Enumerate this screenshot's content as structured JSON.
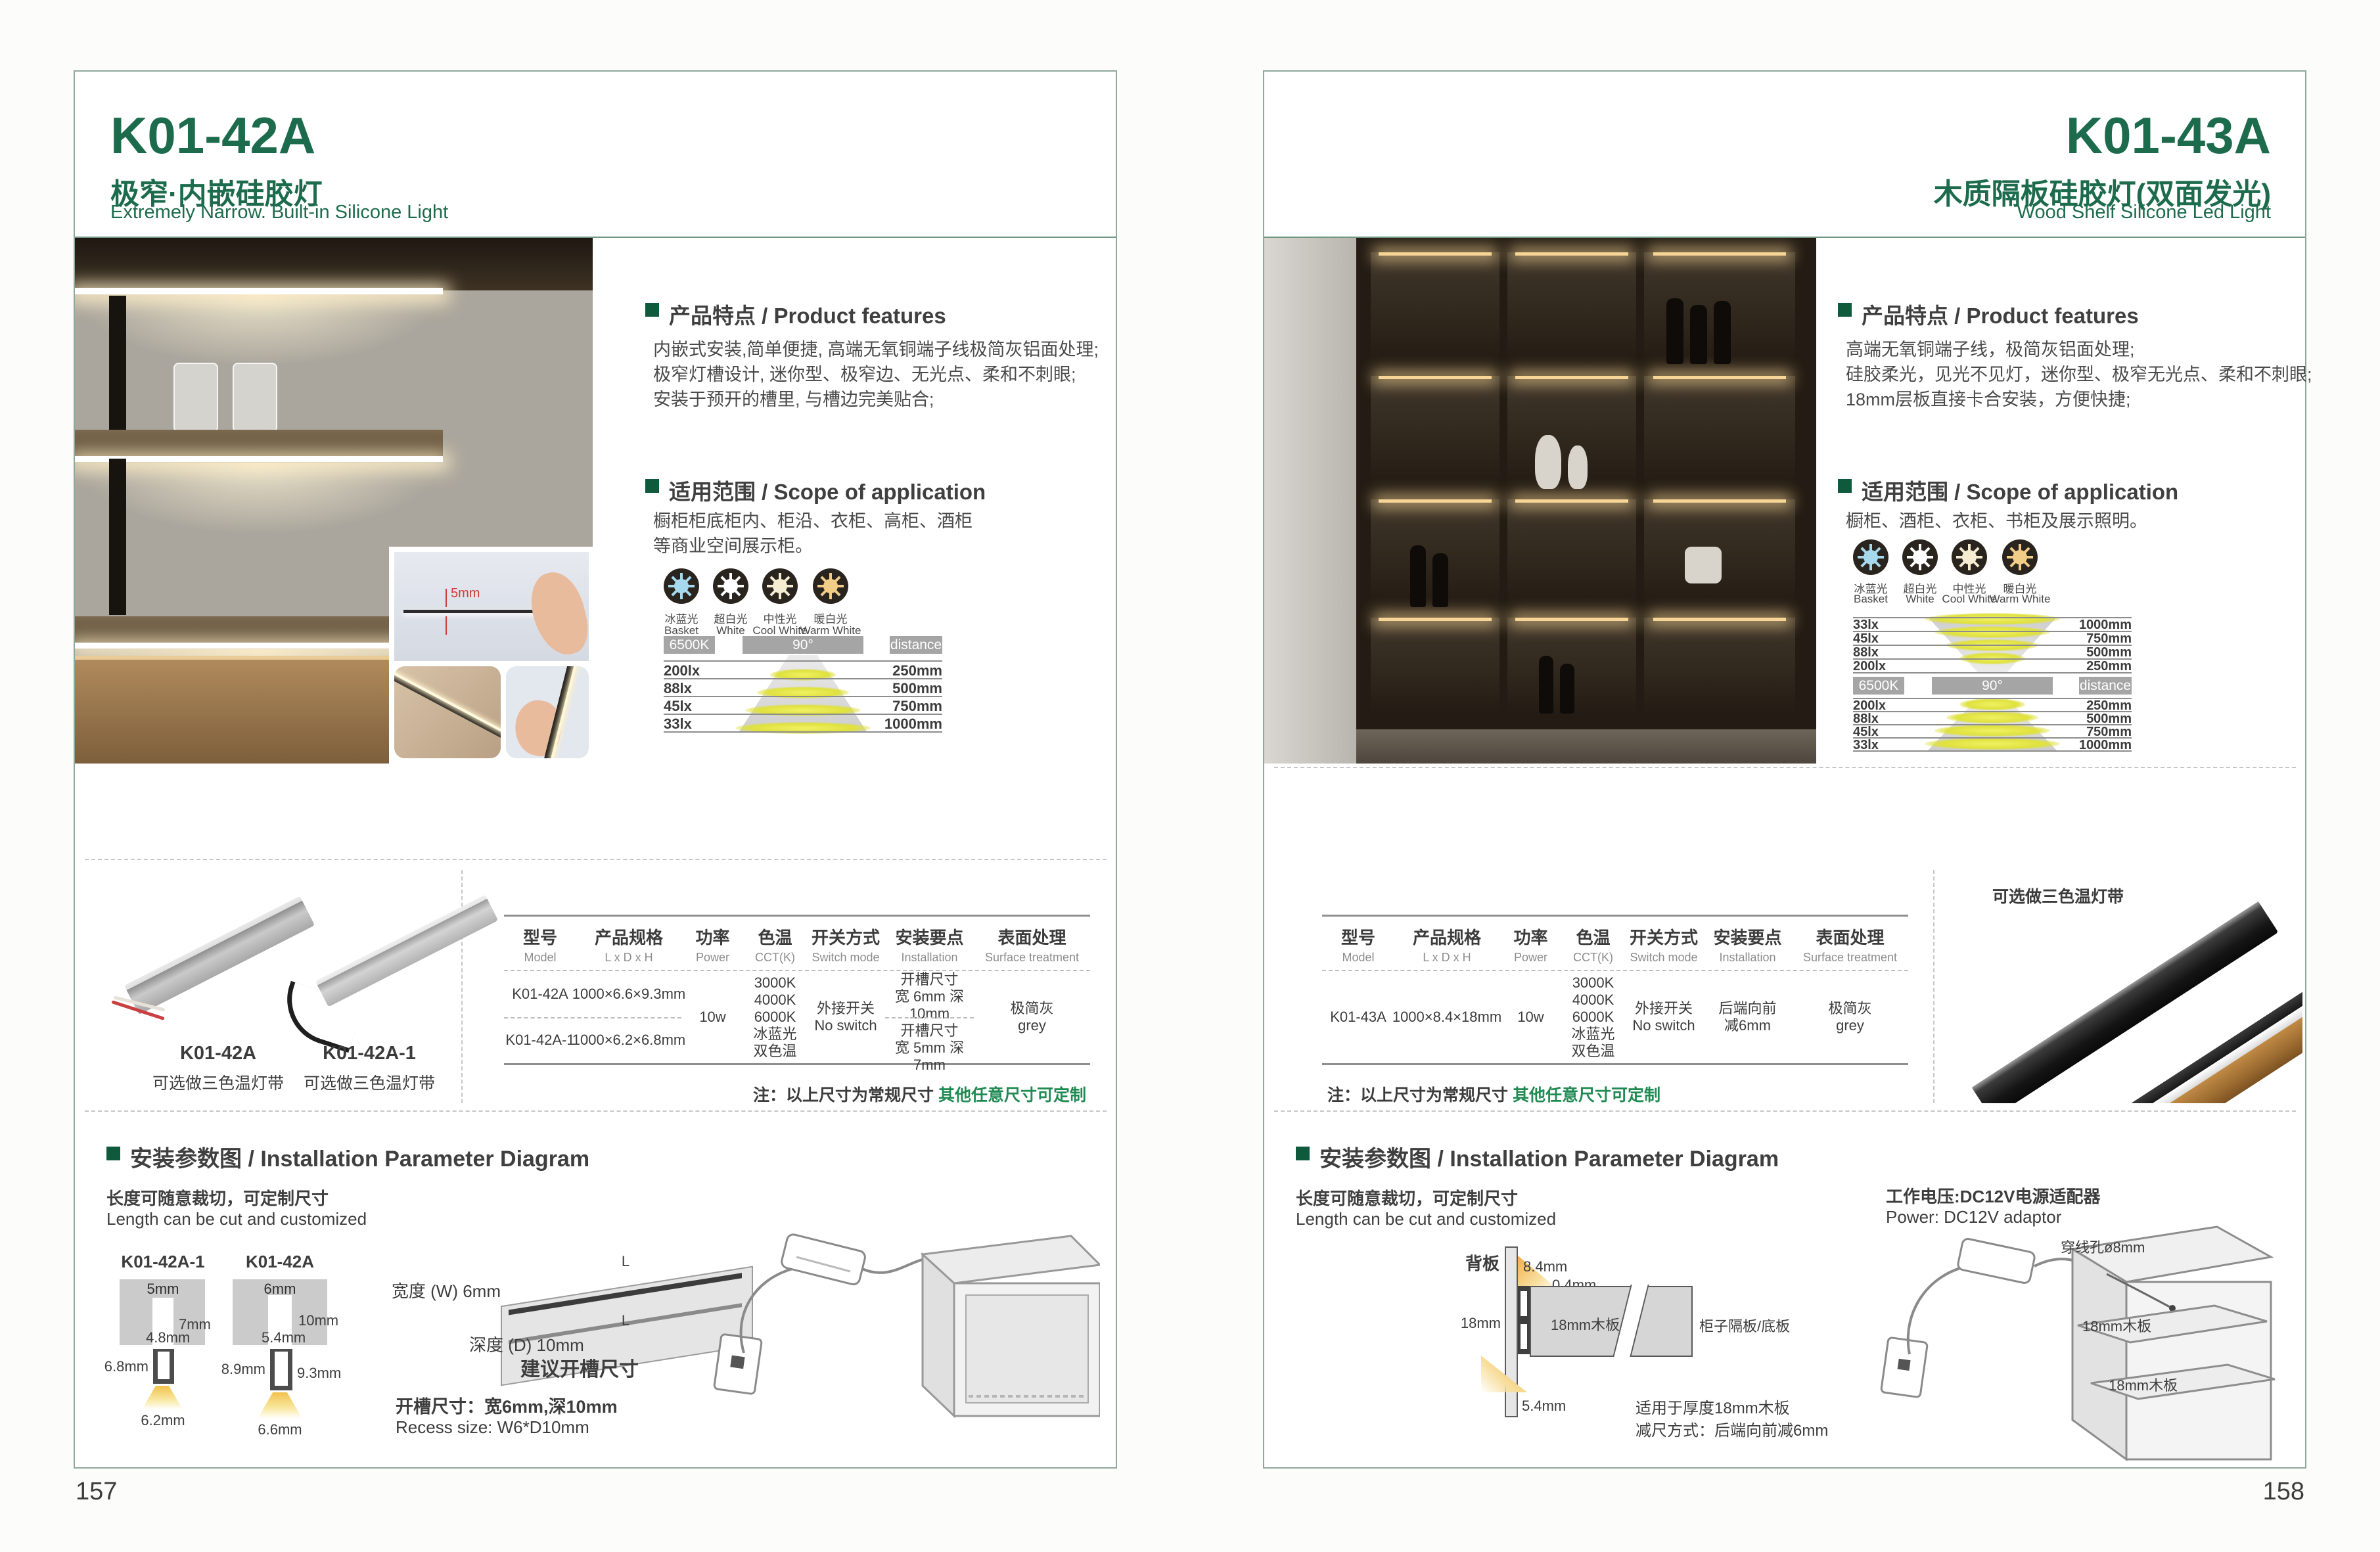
{
  "meta": {
    "page_left_number": "157",
    "page_right_number": "158"
  },
  "colors": {
    "brand_green": "#1c6b4c",
    "bullet_green": "#0f5a3d",
    "note_green": "#1f8a52",
    "frame_border": "#8fa89b",
    "chart_bar_gray": "#a5a5a5",
    "icon_ice_blue": "#a6d9ee",
    "icon_white": "#ffffff",
    "icon_cool_white": "#f6ecd1",
    "icon_warm_white": "#f2cd88"
  },
  "shared": {
    "light_icons": [
      {
        "cn": "冰蓝光",
        "en": "Basket",
        "color": "#a6d9ee"
      },
      {
        "cn": "超白光",
        "en": "White",
        "color": "#ffffff"
      },
      {
        "cn": "中性光",
        "en": "Cool White",
        "color": "#f6ecd1"
      },
      {
        "cn": "暖白光",
        "en": "Warm White",
        "color": "#f2cd88"
      }
    ],
    "chart": {
      "cct": "6500K",
      "angle": "90°",
      "distance": "distance",
      "rows": [
        {
          "lux": "200lx",
          "d": "250mm"
        },
        {
          "lux": "88lx",
          "d": "500mm"
        },
        {
          "lux": "45lx",
          "d": "750mm"
        },
        {
          "lux": "33lx",
          "d": "1000mm"
        }
      ],
      "rows_rev": [
        {
          "lux": "33lx",
          "d": "1000mm"
        },
        {
          "lux": "45lx",
          "d": "750mm"
        },
        {
          "lux": "88lx",
          "d": "500mm"
        },
        {
          "lux": "200lx",
          "d": "250mm"
        }
      ]
    },
    "table_headers": [
      {
        "cn": "型号",
        "en": "Model"
      },
      {
        "cn": "产品规格",
        "en": "L x D x H"
      },
      {
        "cn": "功率",
        "en": "Power"
      },
      {
        "cn": "色温",
        "en": "CCT(K)"
      },
      {
        "cn": "开关方式",
        "en": "Switch mode"
      },
      {
        "cn": "安装要点",
        "en": "Installation"
      },
      {
        "cn": "表面处理",
        "en": "Surface treatment"
      }
    ],
    "note": {
      "prefix": "注：以上尺寸为常规尺寸 ",
      "highlight": "其他任意尺寸可定制"
    },
    "install_heading": "安装参数图 / Installation Parameter Diagram",
    "cut_cn": "长度可随意裁切，可定制尺寸",
    "cut_en": "Length can be cut and customized"
  },
  "left": {
    "model": "K01-42A",
    "title_cn": "极窄·内嵌硅胶灯",
    "title_en": "Extremely Narrow. Built-in Silicone Light",
    "features_heading": "产品特点 / Product features",
    "features": [
      "内嵌式安装,简单便捷, 高端无氧铜端子线极简灰铝面处理;",
      "极窄灯槽设计, 迷你型、极窄边、无光点、柔和不刺眼;",
      "安装于预开的槽里, 与槽边完美贴合;"
    ],
    "scope_heading": "适用范围 / Scope of application",
    "scope": [
      "橱柜柜底柜内、柜沿、衣柜、高柜、酒柜",
      "等商业空间展示柜。"
    ],
    "photo_dim": "5mm",
    "products": [
      {
        "model": "K01-42A",
        "note": "可选做三色温灯带"
      },
      {
        "model": "K01-42A-1",
        "note": "可选做三色温灯带"
      }
    ],
    "table": {
      "rows": [
        {
          "model": "K01-42A",
          "spec": "1000×6.6×9.3mm"
        },
        {
          "model": "K01-42A-1",
          "spec": "1000×6.2×6.8mm"
        }
      ],
      "power": "10w",
      "cct": [
        "3000K",
        "4000K",
        "6000K",
        "冰蓝光",
        "双色温"
      ],
      "switch": [
        "外接开关",
        "No switch"
      ],
      "install1": [
        "开槽尺寸",
        "宽 6mm 深 10mm"
      ],
      "install2": [
        "开槽尺寸",
        "宽 5mm 深 7mm"
      ],
      "surface": [
        "极简灰",
        "grey"
      ]
    },
    "install": {
      "d1_label": "K01-42A-1",
      "d1": {
        "top": "5mm",
        "right": "7mm",
        "inner": "4.8mm",
        "side": "6.8mm",
        "bottom": "6.2mm"
      },
      "d2_label": "K01-42A",
      "d2": {
        "top": "6mm",
        "right": "10mm",
        "inner": "5.4mm",
        "side": "8.9mm",
        "right2": "9.3mm",
        "bottom": "6.6mm"
      },
      "board": {
        "L_top": "L",
        "L_bottom": "L",
        "width": "宽度 (W) 6mm",
        "depth": "深度 (D) 10mm",
        "suggest": "建议开槽尺寸"
      },
      "recess_cn": "开槽尺寸：宽6mm,深10mm",
      "recess_en": "Recess size: W6*D10mm"
    }
  },
  "right": {
    "model": "K01-43A",
    "title_cn": "木质隔板硅胶灯(双面发光)",
    "title_en": "Wood Shelf Silicone Led Light",
    "features_heading": "产品特点 / Product features",
    "features": [
      "高端无氧铜端子线，极简灰铝面处理;",
      "硅胶柔光，见光不见灯，迷你型、极窄无光点、柔和不刺眼;",
      "18mm层板直接卡合安装，方便快捷;"
    ],
    "scope_heading": "适用范围 / Scope of application",
    "scope": [
      "橱柜、酒柜、衣柜、书柜及展示照明。"
    ],
    "product_note": "可选做三色温灯带",
    "table": {
      "row": {
        "model": "K01-43A",
        "spec": "1000×8.4×18mm",
        "power": "10w",
        "cct": [
          "3000K",
          "4000K",
          "6000K",
          "冰蓝光",
          "双色温"
        ],
        "switch": [
          "外接开关",
          "No switch"
        ],
        "install": [
          "后端向前",
          "减6mm"
        ],
        "surface": [
          "极简灰",
          "grey"
        ]
      }
    },
    "install": {
      "back_label": "背板",
      "dims": {
        "a": "8.4mm",
        "b": "0.4mm",
        "c": "18mm",
        "d": "5.4mm"
      },
      "board_label": "18mm木板",
      "shelf_label": "柜子隔板/底板",
      "fit1": "适用于厚度18mm木板",
      "fit2": "减尺方式：后端向前减6mm",
      "power_cn": "工作电压:DC12V电源适配器",
      "power_en": "Power: DC12V adaptor",
      "hole": "穿线孔ø8mm",
      "wood1": "18mm木板",
      "wood2": "18mm木板"
    }
  }
}
